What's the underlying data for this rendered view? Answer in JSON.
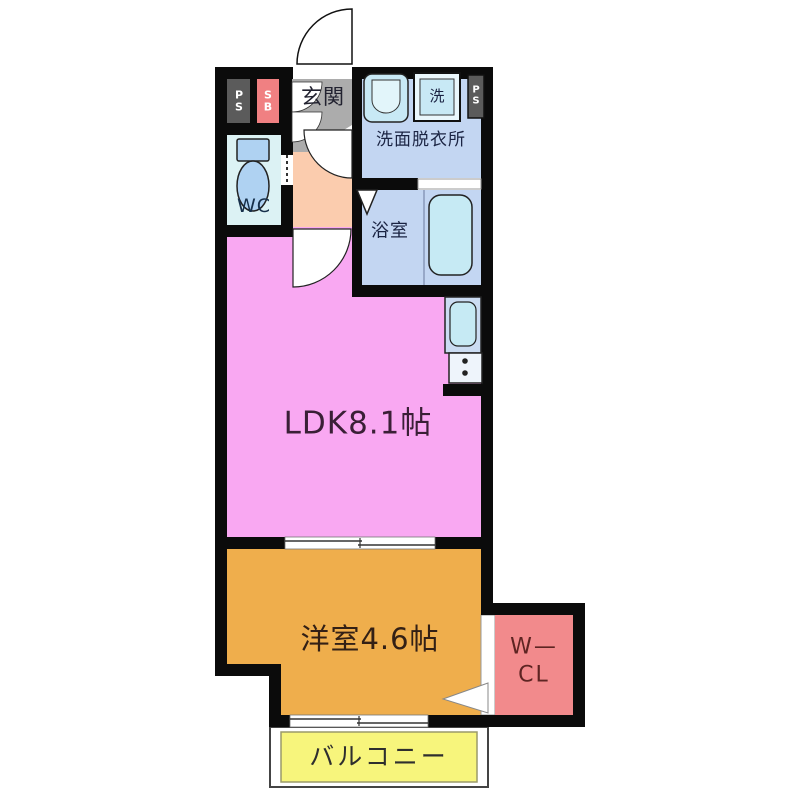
{
  "floorplan": {
    "title": "1LDK apartment floor plan",
    "rooms": {
      "entrance": {
        "label": "玄関",
        "color": "#ACACAC"
      },
      "wc": {
        "label": "WC",
        "color": "#DCF2F4"
      },
      "washroom": {
        "label": "洗面脱衣所",
        "color": "#C3D6F2"
      },
      "bathroom": {
        "label": "浴室",
        "color": "#C3D6F2"
      },
      "ldk": {
        "label": "LDK8.1帖",
        "color": "#F9A8F2"
      },
      "western_room": {
        "label": "洋室4.6帖",
        "color": "#EFAE4C"
      },
      "walk_in_closet": {
        "label_line1": "W—",
        "label_line2": "CL",
        "color": "#F28A8C"
      },
      "balcony": {
        "label": "バルコニー",
        "color": "#F7F57C"
      },
      "hallway": {
        "color": "#FBCCAE"
      }
    },
    "shafts": {
      "ps_left": {
        "line1": "P",
        "line2": "S",
        "color": "#5B5B5B"
      },
      "sb": {
        "line1": "S",
        "line2": "B",
        "color": "#F08082"
      },
      "ps_right": {
        "line1": "P",
        "line2": "S",
        "color": "#5B5B5B"
      }
    },
    "fixtures": {
      "washing_machine": {
        "label": "洗"
      }
    },
    "wall_color": "#0b0b0b",
    "fixture_fill": "#C6EAF4"
  }
}
